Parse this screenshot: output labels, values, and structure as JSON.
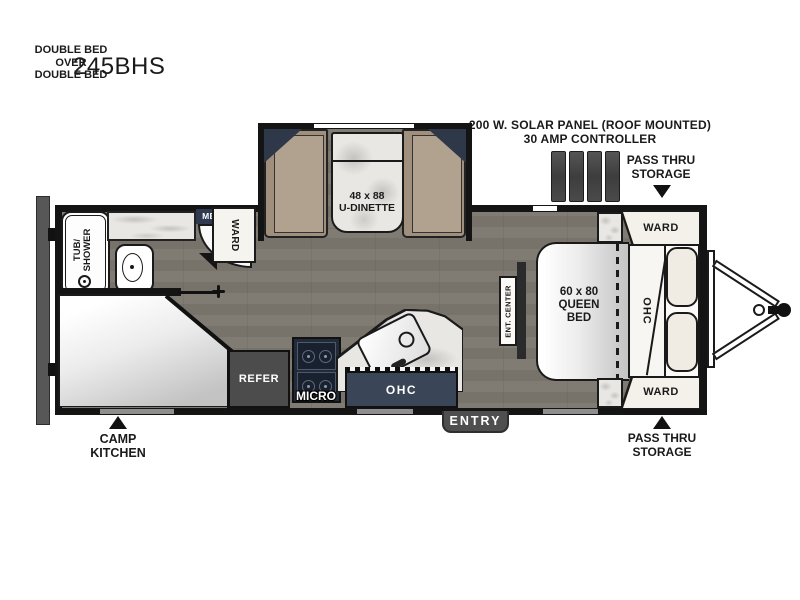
{
  "title": "245BHS",
  "annotations": {
    "solar_line1": "200 W. SOLAR PANEL (ROOF MOUNTED)",
    "solar_line2": "30 AMP CONTROLLER",
    "pass_thru_top": [
      "PASS THRU",
      "STORAGE"
    ],
    "pass_thru_bottom": [
      "PASS THRU",
      "STORAGE"
    ],
    "camp_kitchen": [
      "CAMP",
      "KITCHEN"
    ],
    "entry": "ENTRY"
  },
  "rooms": {
    "dinette": {
      "size": "48 x 88",
      "name": "U-DINETTE"
    },
    "queen_bed": {
      "size": "60 x 80",
      "line2": "QUEEN",
      "line3": "BED"
    },
    "bunk": [
      "DOUBLE BED",
      "OVER",
      "DOUBLE BED"
    ],
    "tub_shower": [
      "TUB/",
      "SHOWER"
    ],
    "med_cab": "MED CAB",
    "ward_bath": "WARD",
    "ward_top": "WARD",
    "ward_bottom": "WARD",
    "refer": "REFER",
    "micro": "MICRO",
    "ohc_kitchen": "OHC",
    "ohc_bedroom": "OHC",
    "ent_center": "ENT. CENTER"
  },
  "colors": {
    "wall": "#141414",
    "floor": "#b2aea8",
    "cabinet_navy": "#3a4557",
    "slide_corner_navy": "#2e3848",
    "appliance_gray": "#4c4c4c",
    "bench_tan": "#a08f7d",
    "marble": "#e9e7e3"
  }
}
